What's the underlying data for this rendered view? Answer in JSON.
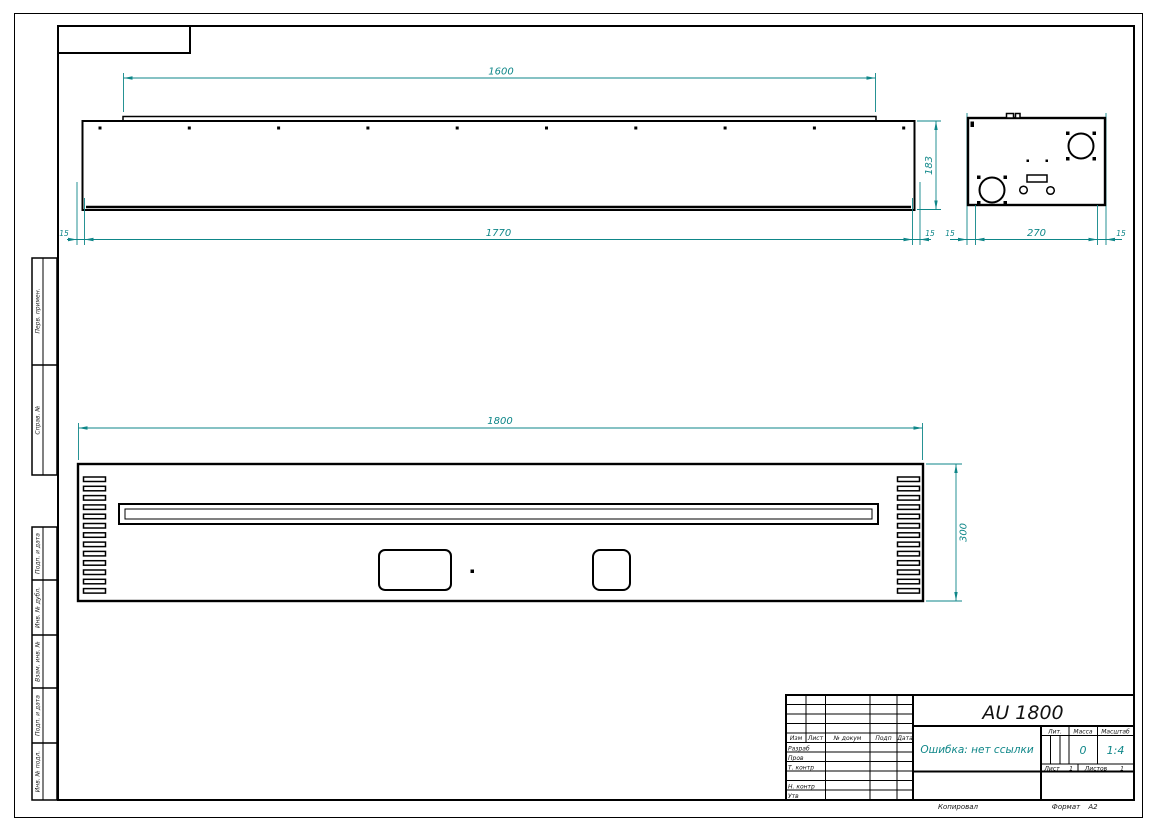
{
  "title_block": {
    "title": "AU 1800",
    "doc_note": "Ошибка: нет ссылки",
    "lit_label": "Лит.",
    "mass_label": "Масса",
    "scale_label": "Масштаб",
    "mass_value": "0",
    "scale_value": "1:4",
    "sheet_label": "Лист",
    "sheet_value": "1",
    "sheets_label": "Листов",
    "sheets_value": "1",
    "header_cols": {
      "izm": "Изм",
      "list": "Лист",
      "ndoc": "№ докум",
      "podp": "Подп",
      "data": "Дата"
    },
    "rows": {
      "razrab": "Разраб",
      "prov": "Пров",
      "tkontr": "Т. контр",
      "nkontr": "Н. контр",
      "utv": "Утв"
    },
    "copied_label": "Копировал",
    "format_label": "Формат",
    "format_value": "А2"
  },
  "margin_columns": {
    "perv_primen": "Перв. примен.",
    "sprav_no": "Справ. №",
    "podp_data_1": "Подп. и дата",
    "inv_dubl": "Инв. № дубл.",
    "vzam_inv": "Взам. инв. №",
    "podp_data_2": "Подп. и дата",
    "inv_podl": "Инв. № подл."
  },
  "dims": {
    "front": {
      "width_top": "1600",
      "width_bottom": "1770",
      "flange_left": "15",
      "flange_right": "15",
      "height": "183"
    },
    "side": {
      "wall_left": "15",
      "depth": "270",
      "wall_right": "15"
    },
    "bottom": {
      "width": "1800",
      "depth": "300"
    }
  },
  "counts": {
    "front_top_holes": 10,
    "vent_slots_per_column": 13
  },
  "colors": {
    "dim_color": "#0e8688",
    "line_color": "#000000"
  }
}
